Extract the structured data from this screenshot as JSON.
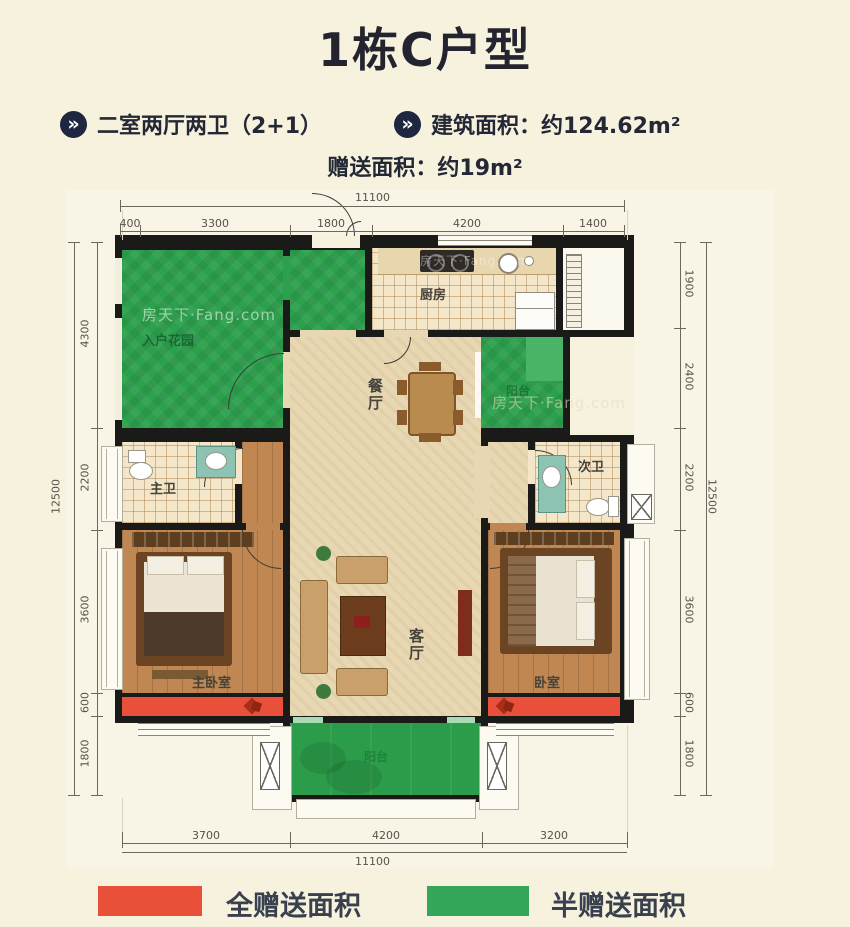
{
  "page": {
    "background": "#f7f2de"
  },
  "header": {
    "title": "1栋C户型",
    "bullet_icon": "»",
    "features": [
      {
        "label": "二室两厅两卫（2+1）"
      },
      {
        "label": "建筑面积：约124.62m²"
      }
    ],
    "bonus": "赠送面积：约19m²"
  },
  "watermark": "房天下·Fang.com",
  "plan": {
    "rooms": {
      "entry_garden": "入户花园",
      "kitchen": "厨房",
      "dining": "餐厅",
      "living": "客厅",
      "master_bath": "主卫",
      "second_bath": "次卫",
      "master_bedroom": "主卧室",
      "bedroom": "卧室",
      "balcony_side": "阳台",
      "balcony_bottom": "阳台"
    },
    "dimensions": {
      "top_total": "11100",
      "top_segments": [
        "400",
        "3300",
        "1800",
        "4200",
        "1400"
      ],
      "bottom_segments": [
        "3700",
        "4200",
        "3200"
      ],
      "bottom_total": "11100",
      "left_segments": [
        "4300",
        "2200",
        "3600",
        "600",
        "1800"
      ],
      "left_total": "12500",
      "right_segments": [
        "1900",
        "2400",
        "2200",
        "3600",
        "600",
        "1800"
      ],
      "right_total": "12500"
    },
    "colors": {
      "wall": "#1a1a18",
      "full_gift_red": "#e8503a",
      "half_gift_green": "#2ca04d",
      "floor_beige": "#e7d8b3",
      "wood": "#c08752",
      "tile": "#f4e6c8"
    }
  },
  "legend": [
    {
      "label": "全赠送面积",
      "color": "#e8503a"
    },
    {
      "label": "半赠送面积",
      "color": "#33a65a"
    }
  ]
}
